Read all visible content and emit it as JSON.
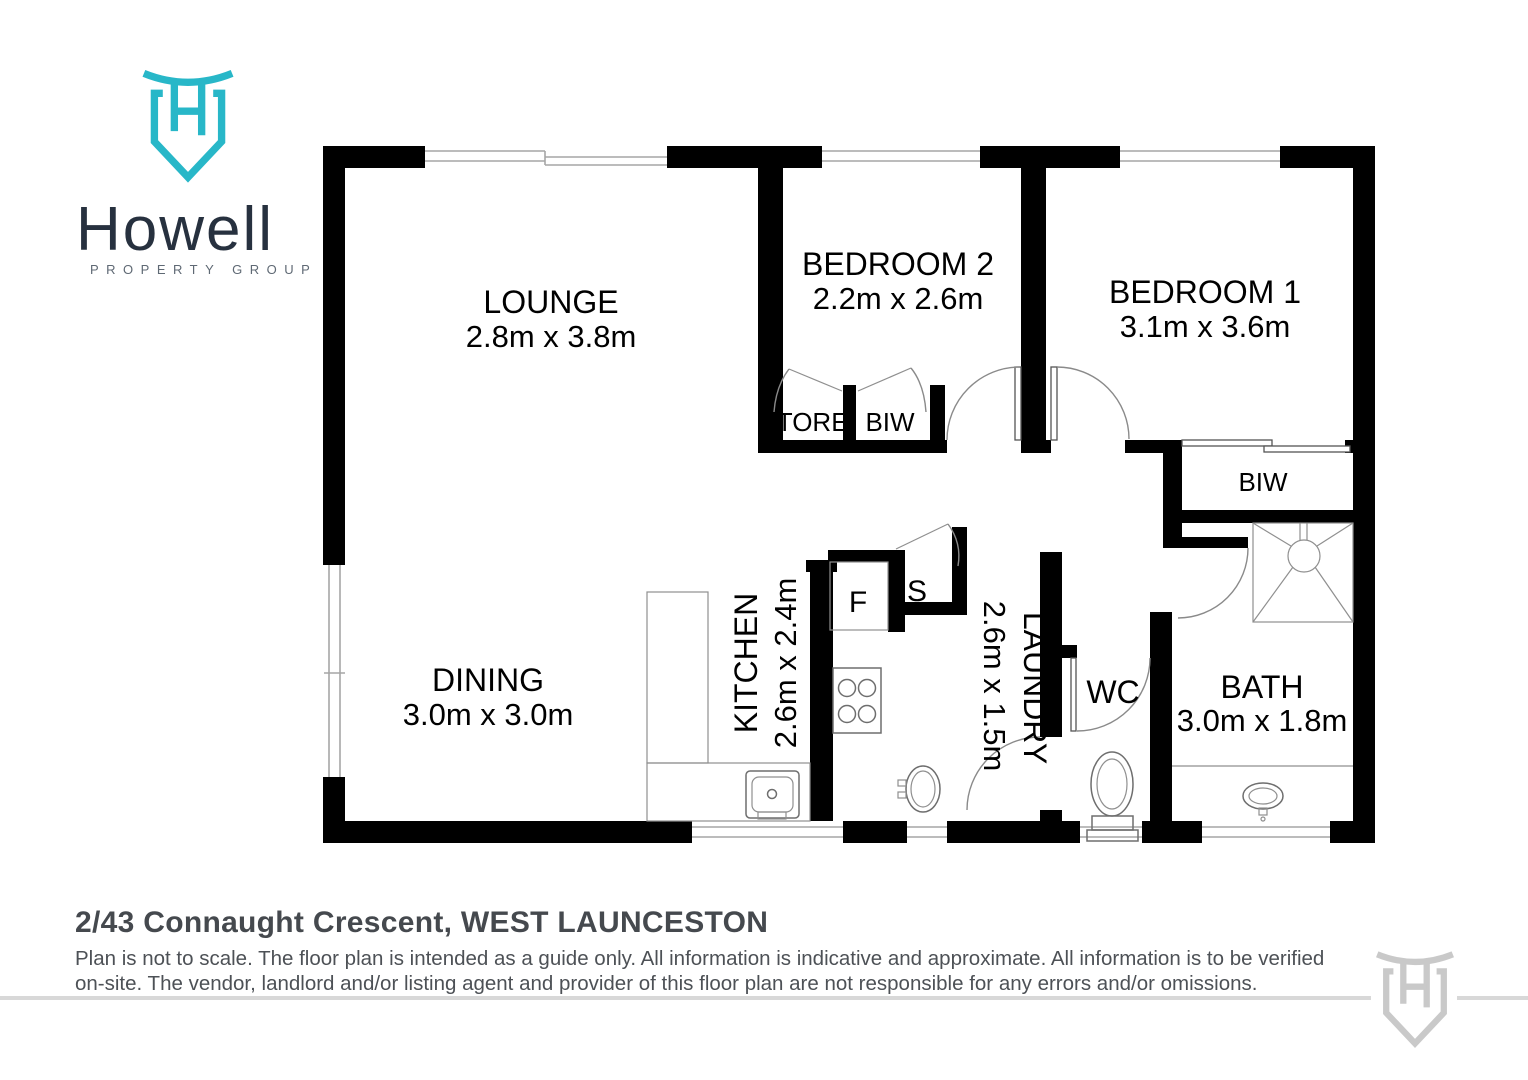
{
  "brand": {
    "name": "Howell",
    "tagline": "PROPERTY GROUP",
    "accent_color": "#28b7c8",
    "navy_color": "#27313f"
  },
  "plan": {
    "rooms": {
      "lounge": {
        "name": "LOUNGE",
        "dims": "2.8m x 3.8m"
      },
      "bedroom2": {
        "name": "BEDROOM 2",
        "dims": "2.2m x 2.6m"
      },
      "bedroom1": {
        "name": "BEDROOM 1",
        "dims": "3.1m x 3.6m"
      },
      "dining": {
        "name": "DINING",
        "dims": "3.0m x 3.0m"
      },
      "kitchen": {
        "name": "KITCHEN",
        "dims": "2.6m x 2.4m"
      },
      "laundry": {
        "name": "LAUNDRY",
        "dims": "2.6m x 1.5m"
      },
      "wc": {
        "name": "WC"
      },
      "bath": {
        "name": "BATH",
        "dims": "3.0m x 1.8m"
      },
      "store": {
        "name": "STORE"
      },
      "biw_bed2": {
        "name": "BIW"
      },
      "biw_bed1": {
        "name": "BIW"
      }
    },
    "markers": {
      "fridge": "F",
      "storage": "S"
    }
  },
  "footer": {
    "address": "2/43 Connaught Crescent, WEST LAUNCESTON",
    "disclaimer_line1": "Plan is not to scale. The floor plan is intended as a guide only. All information is indicative and approximate. All information is to be verified",
    "disclaimer_line2": "on-site.  The vendor, landlord and/or listing agent and provider of this floor plan are not responsible for any errors and/or omissions."
  }
}
